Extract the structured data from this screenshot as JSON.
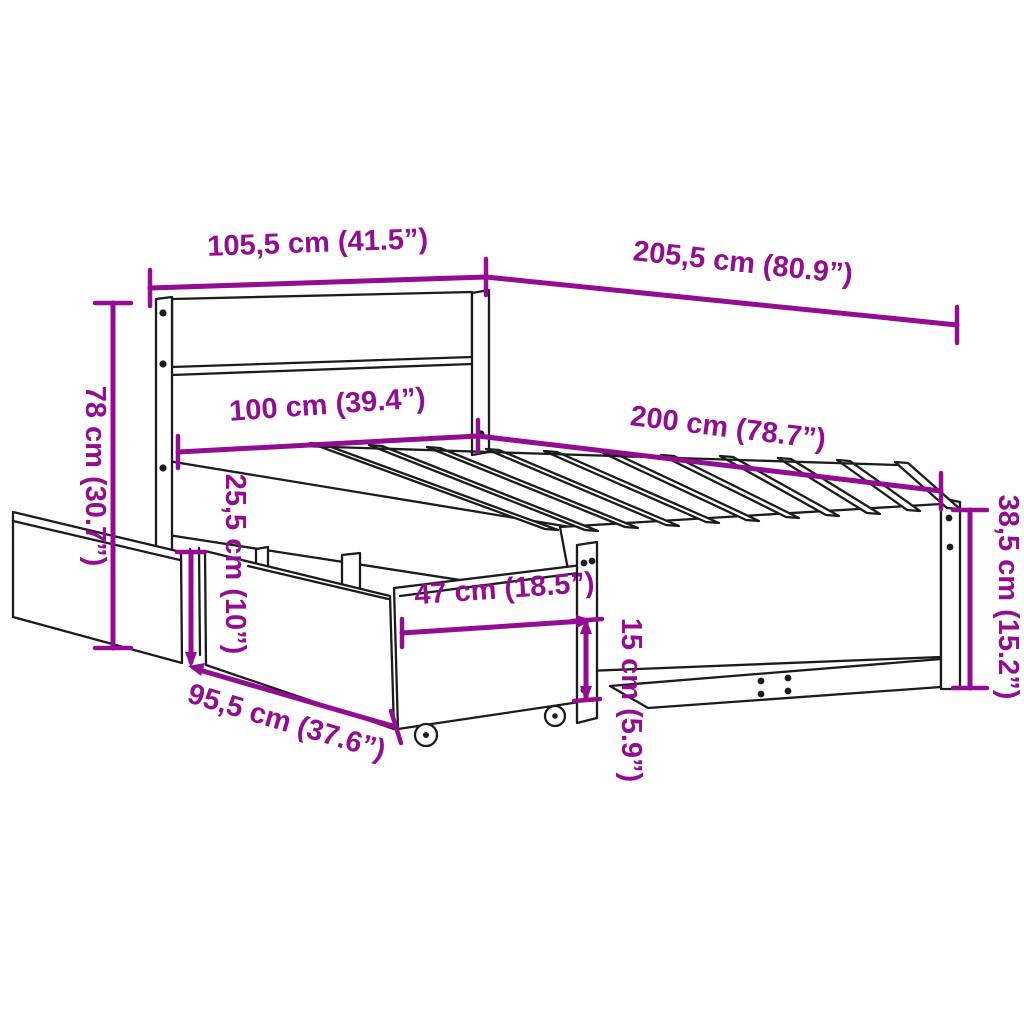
{
  "diagram": {
    "subject": "bed-frame-with-storage-drawers-dimension-diagram",
    "colors": {
      "dimension_accent": "#930D93",
      "drawing_line": "#1c1c1c",
      "background": "#ffffff"
    },
    "dimensions": [
      {
        "id": "headboard-width",
        "label": "105,5 cm (41.5”)"
      },
      {
        "id": "total-length",
        "label": "205,5 cm (80.9”)"
      },
      {
        "id": "mattress-width",
        "label": "100 cm (39.4”)"
      },
      {
        "id": "mattress-length",
        "label": "200 cm (78.7”)"
      },
      {
        "id": "headboard-height",
        "label": "78 cm (30.7”)"
      },
      {
        "id": "drawer-height",
        "label": "25,5 cm (10”)"
      },
      {
        "id": "drawer-depth",
        "label": "47 cm (18.5”)"
      },
      {
        "id": "under-bed-clearance",
        "label": "15 cm (5.9”)"
      },
      {
        "id": "drawer-width",
        "label": "95,5 cm (37.6”)"
      },
      {
        "id": "footboard-height",
        "label": "38,5 cm (15.2”)"
      }
    ]
  }
}
